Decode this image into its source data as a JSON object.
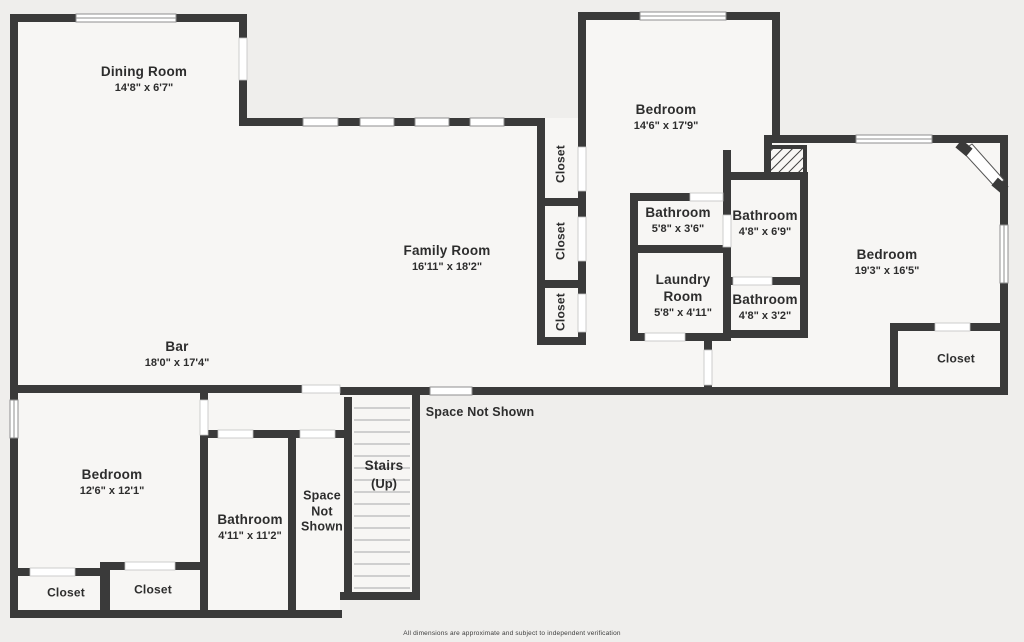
{
  "colors": {
    "wall": "#3a3a3a",
    "room_fill": "#f7f6f4",
    "background": "#efeeec",
    "tread": "#cfcfcf",
    "window_frame": "#8f8f8f"
  },
  "rooms": [
    {
      "name": "Dining Room",
      "dims": "14'8\" x 6'7\""
    },
    {
      "name": "Family Room",
      "dims": "16'11\" x 18'2\""
    },
    {
      "name": "Bar",
      "dims": "18'0\" x 17'4\""
    },
    {
      "name": "Bedroom",
      "dims": "14'6\" x 17'9\""
    },
    {
      "name": "Bedroom",
      "dims": "19'3\" x 16'5\""
    },
    {
      "name": "Bedroom",
      "dims": "12'6\" x 12'1\""
    },
    {
      "name": "Bathroom",
      "dims": "5'8\" x 3'6\""
    },
    {
      "name": "Bathroom",
      "dims": "4'8\" x 6'9\""
    },
    {
      "name": "Bathroom",
      "dims": "4'8\" x 3'2\""
    },
    {
      "name": "Bathroom",
      "dims": "4'11\" x 11'2\""
    },
    {
      "name": "Laundry Room",
      "dims": "5'8\" x 4'11\""
    },
    {
      "name": "Stairs",
      "dims": "(Up)"
    },
    {
      "name": "Closet"
    },
    {
      "name": "Closet"
    },
    {
      "name": "Closet"
    },
    {
      "name": "Closet"
    },
    {
      "name": "Closet"
    },
    {
      "name": "Closet"
    },
    {
      "name": "Space Not Shown"
    },
    {
      "name": "Space Not Shown"
    }
  ],
  "footer": {
    "disclaimer": "All dimensions are approximate and subject to independent verification"
  }
}
